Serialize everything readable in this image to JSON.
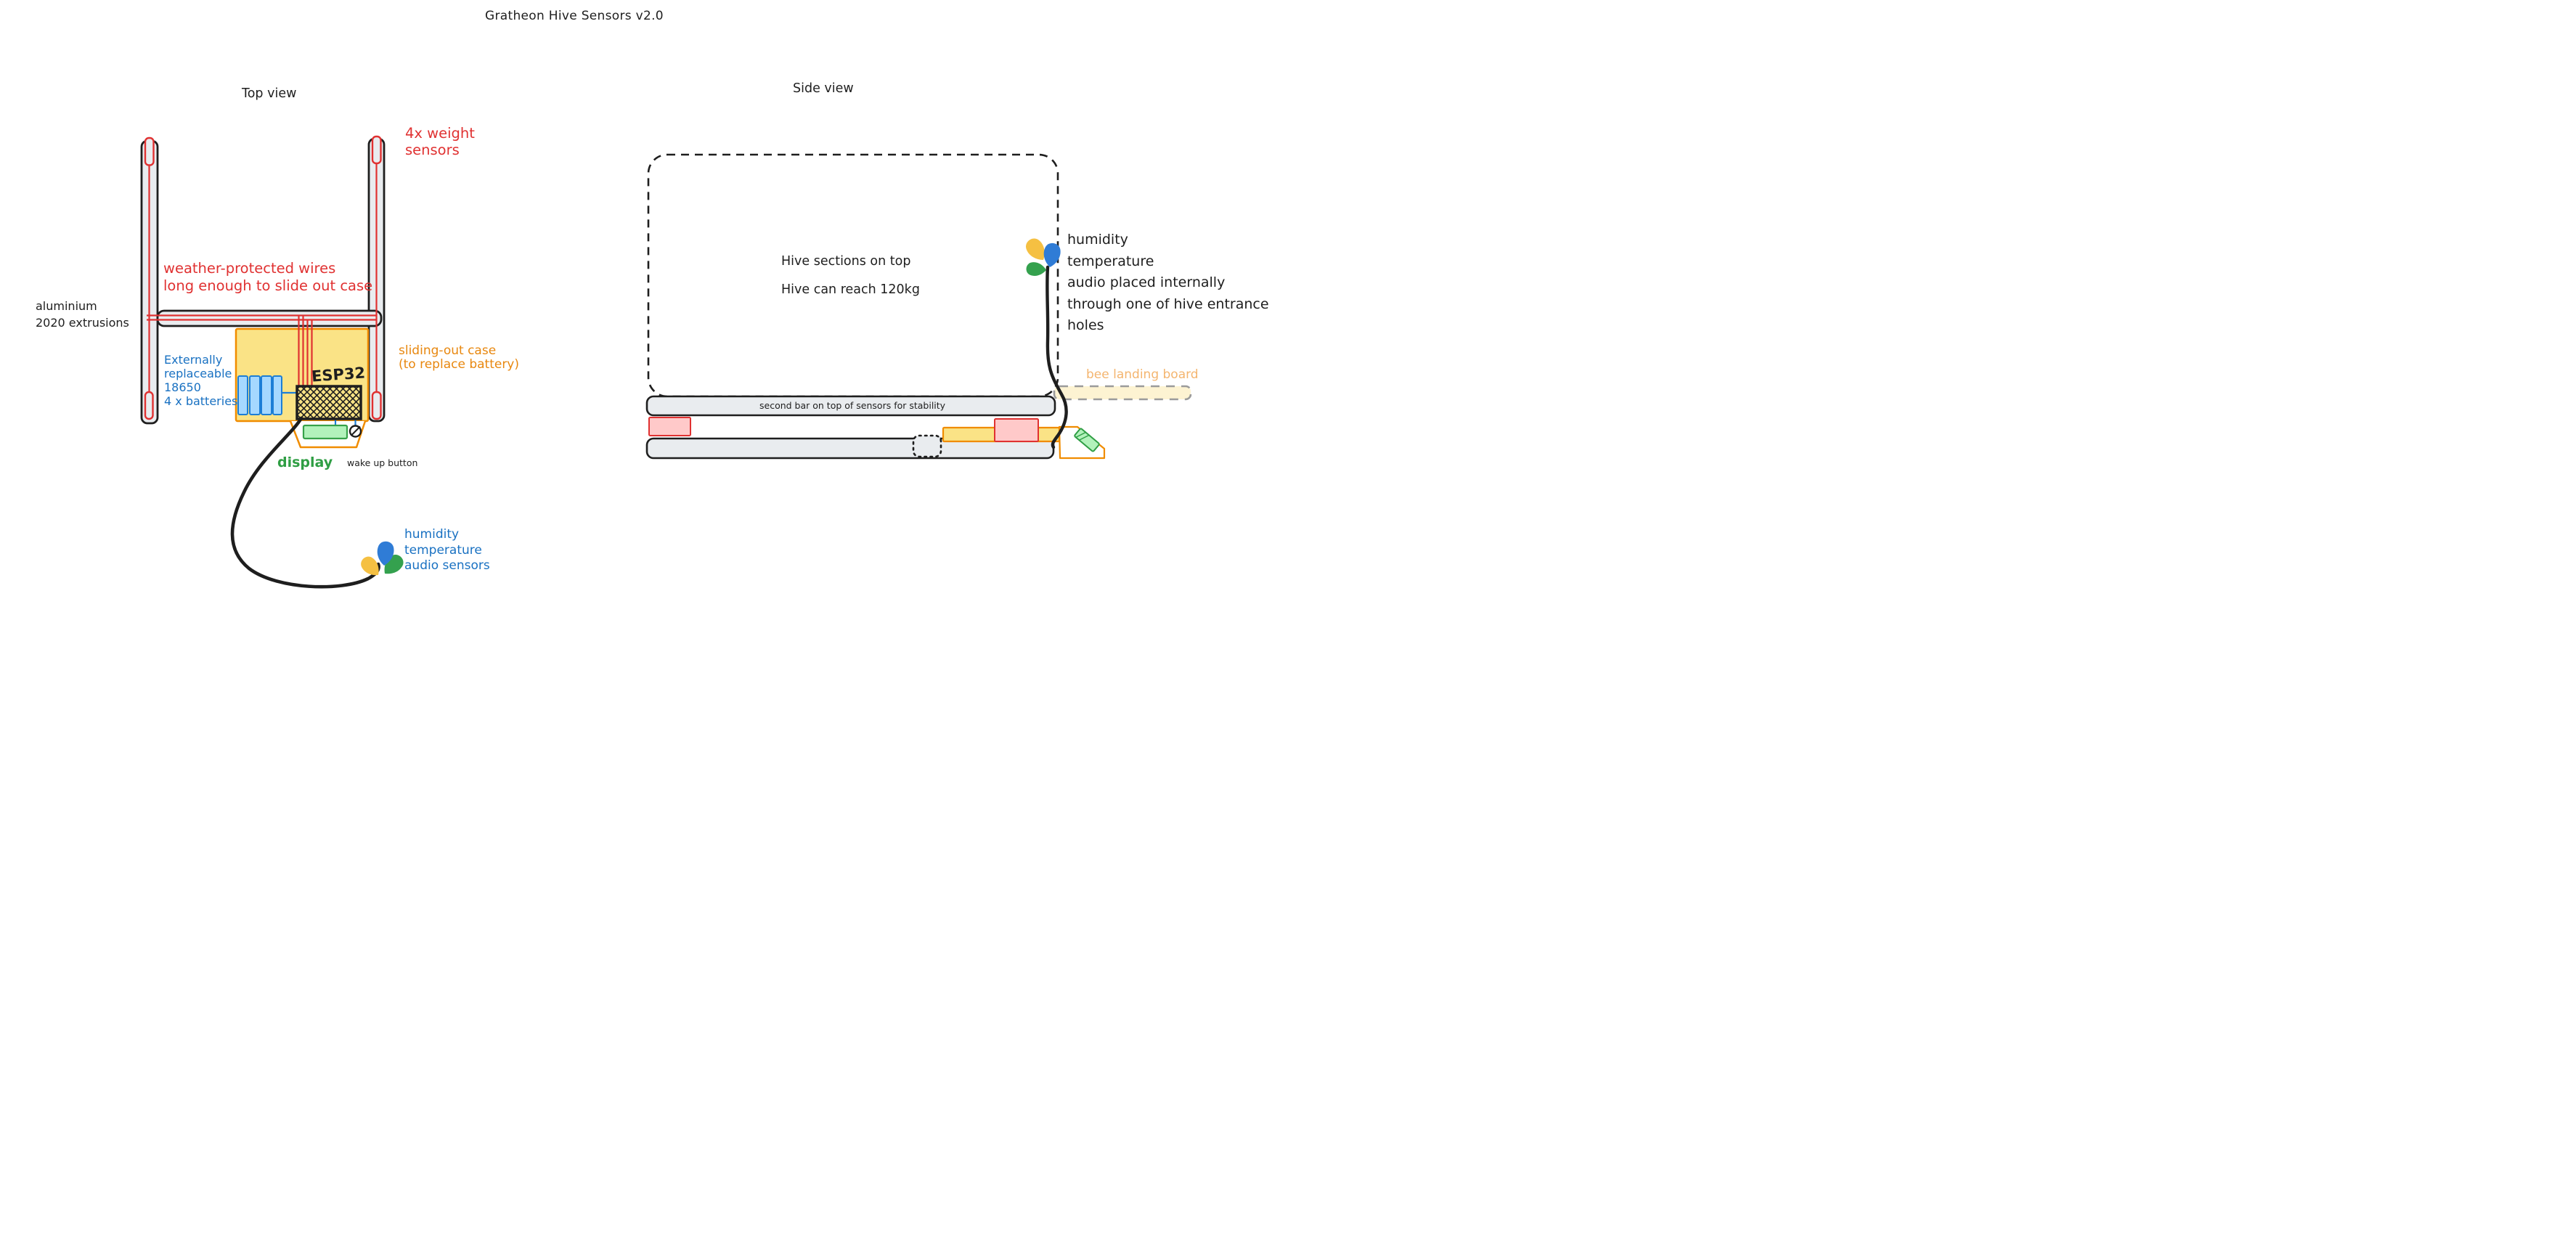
{
  "title": "Gratheon Hive Sensors v2.0",
  "top_view": {
    "label": "Top view",
    "weight_sensors_label": "4x weight\nsensors",
    "wires_label": "weather-protected wires\nlong enough to slide out case",
    "extrusions_label": "aluminium\n2020 extrusions",
    "batteries_label": "Externally\nreplaceable\n18650\n4 x batteries",
    "sliding_case_label": "sliding-out case\n(to replace battery)",
    "esp32_label": "ESP32",
    "display_label": "display",
    "wake_button_label": "wake up button",
    "sensor_cluster_label": "humidity\ntemperature\naudio sensors"
  },
  "side_view": {
    "label": "Side view",
    "hive_text_line1": "Hive sections on top",
    "hive_text_line2": "Hive can reach 120kg",
    "internal_sensors_label": "humidity\ntemperature\naudio placed internally\nthrough one of hive entrance holes",
    "bee_board_label": "bee landing board",
    "stability_bar_label": "second bar on top of sensors for stability"
  },
  "colors": {
    "ink": "#1e1e1e",
    "red": "#e03131",
    "pink_fill": "#ffc9c9",
    "orange": "#f08c00",
    "orange_text": "#e8870e",
    "pale_orange_text": "#f4b56f",
    "case_yellow_fill": "#fae386",
    "board_yellow_fill": "#fdf3d2",
    "blue_text": "#1971c2",
    "battery_fill": "#a5d8ff",
    "battery_stroke": "#1c7ed6",
    "green": "#2f9e44",
    "display_fill": "#b2f2bb",
    "bar_gray_fill": "#e9ecef",
    "board_dash_gray": "#9b9b9b",
    "drop_blue": "#2f7cd6",
    "drop_yellow": "#f5c042",
    "drop_green": "#34a14e"
  }
}
